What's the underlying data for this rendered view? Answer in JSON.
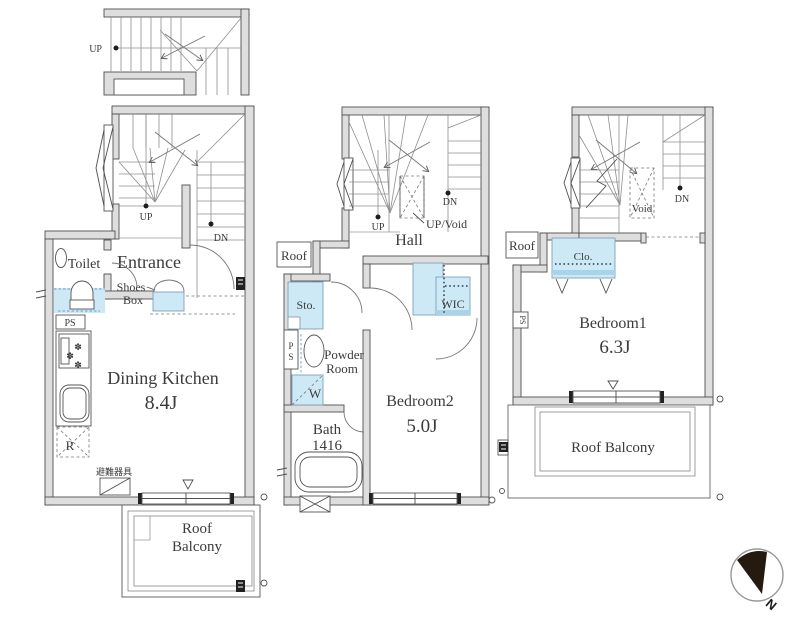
{
  "colors": {
    "wall_fill": "#dedede",
    "line": "#4f4f4f",
    "fixture_blue": "#cde9f6",
    "fixture_blue_dark": "#a9d3e8",
    "text": "#3b3b3b"
  },
  "attic": {
    "up": "UP"
  },
  "f1": {
    "up": "UP",
    "dn": "DN",
    "toilet": "Toilet",
    "entrance": "Entrance",
    "shoes1": "Shoes",
    "shoes2": "Box",
    "ps": "PS",
    "dk": "Dining Kitchen",
    "dk_size": "8.4J",
    "fridge": "R",
    "escape": "避難器具",
    "balcony1": "Roof",
    "balcony2": "Balcony"
  },
  "f2": {
    "roof": "Roof",
    "up": "UP",
    "dn": "DN",
    "up_void": "UP/Void",
    "hall": "Hall",
    "sto": "Sto.",
    "ps1": "P",
    "ps2": "S",
    "powder1": "Powder",
    "powder2": "Room",
    "washer": "W",
    "wic": "WIC",
    "bath": "Bath",
    "bath_size": "1416",
    "bedroom": "Bedroom2",
    "bedroom_size": "5.0J"
  },
  "f3": {
    "roof": "Roof",
    "dn": "DN",
    "void": "Void",
    "closet": "Clo.",
    "ps": "PS",
    "bedroom": "Bedroom1",
    "bedroom_size": "6.3J",
    "balcony": "Roof Balcony"
  },
  "compass": {
    "n": "N"
  }
}
